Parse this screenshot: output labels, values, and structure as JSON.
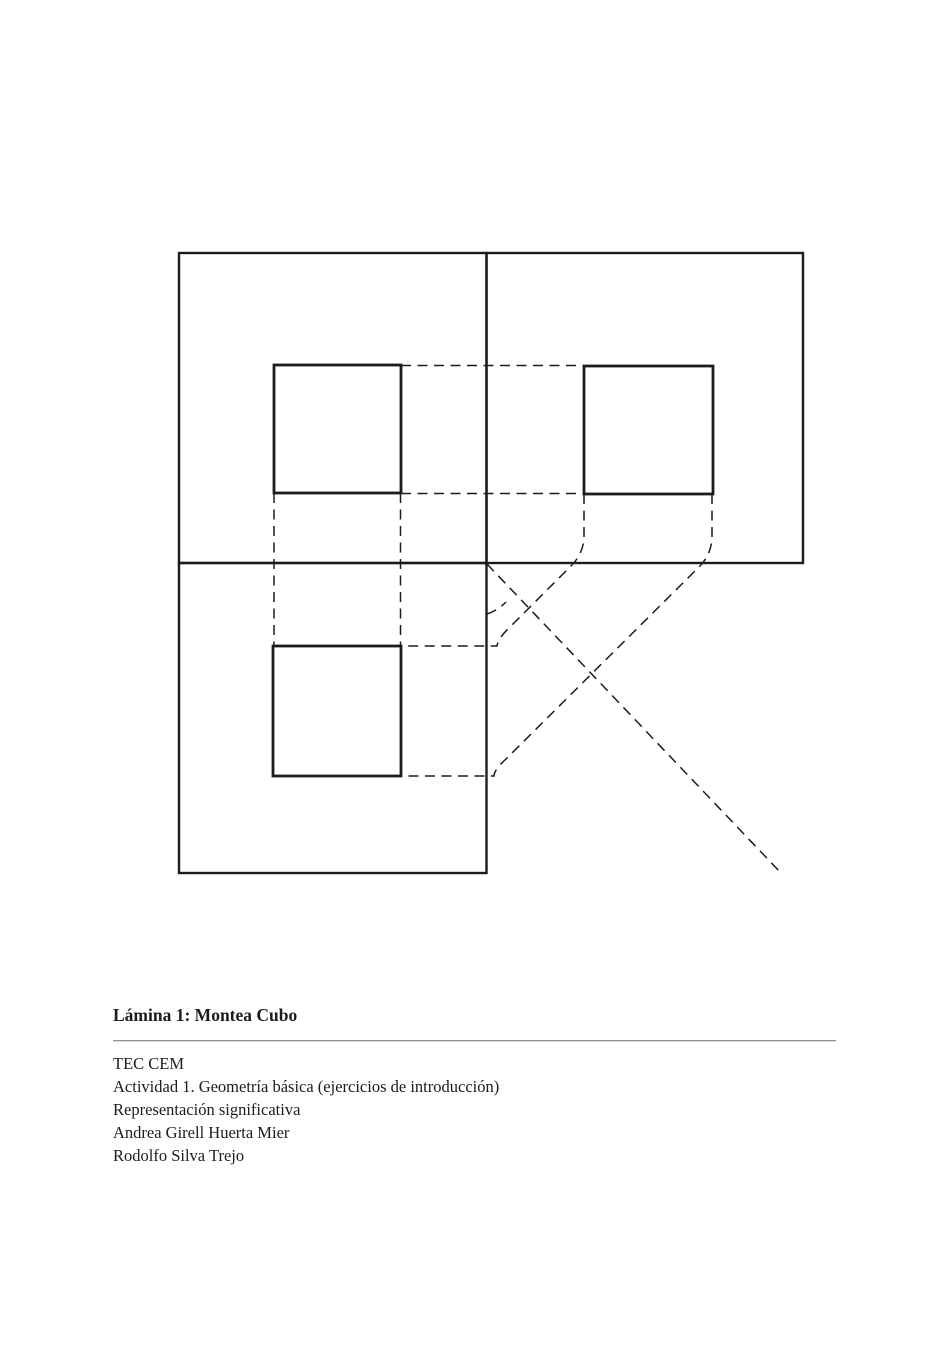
{
  "page": {
    "background": "#ffffff",
    "ink_color": "#1c1c1c",
    "rule_color": "#8f8f8f"
  },
  "figure": {
    "caption_title": "Lámina 1: Montea Cubo",
    "credits": [
      "TEC CEM",
      "Actividad 1. Geometría básica (ejercicios de introducción)",
      "Representación significativa",
      "Andrea Girell Huerta Mier",
      "Rodolfo Silva Trejo"
    ]
  }
}
